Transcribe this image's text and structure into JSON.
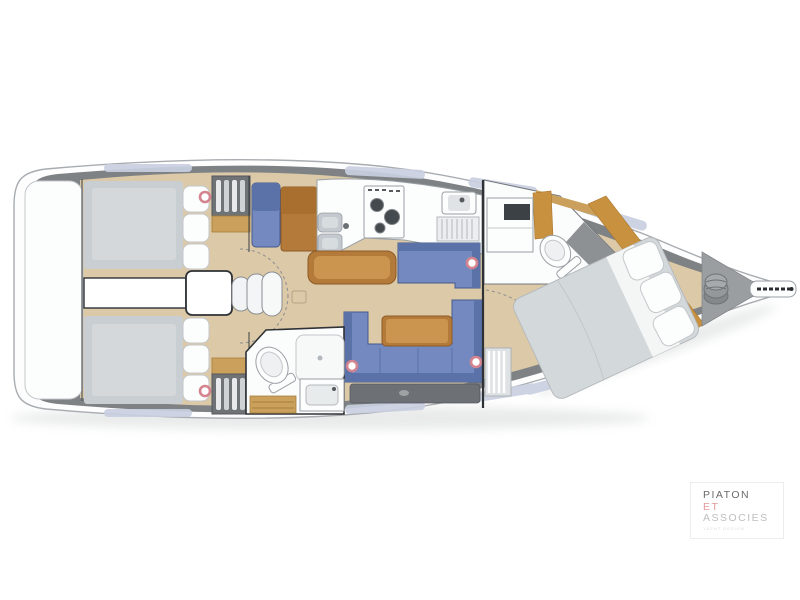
{
  "page": {
    "background": "#ffffff"
  },
  "theme": {
    "page-bg": "#ffffff",
    "hull-fill": "#fdfdfe",
    "hull-stroke": "#a8acb0",
    "deck-gray": "#7e8285",
    "deck-window": "#c9cfe0",
    "floor-wood": "#dcc9a8",
    "floor-plank": "#cdb astro",
    "furniture-wood": "#b37a3a",
    "furniture-wood-dark": "#8c5a26",
    "furniture-wood-light": "#cb9550",
    "furniture-tan": "#caa05c",
    "upholstery-blue": "#7389bf",
    "upholstery-blue-dark": "#5a72a8",
    "upholstery-outline": "#46598b",
    "mattress-gray": "#c9ced2",
    "mattress-gray-light": "#d4d8db",
    "bed-duvet": "#d3d8db",
    "fixture-white": "#fcfdfd",
    "fixture-stroke": "#9aa0a5",
    "soft-stroke": "#c3c7ca",
    "steel-gray": "#c3c9ce",
    "storage-gray": "#6d7175",
    "locker-gray": "#9b9ea1",
    "dark-outline": "#2e3236",
    "hatch-pink": "#d4848e",
    "shadow": "#cfd1d2"
  },
  "floorplan": {
    "type": "sailboat-interior-layout-top-view",
    "orientation": "bow-right-stern-left",
    "areas": [
      "swim-platform",
      "aft-cabin-port",
      "aft-cabin-starboard",
      "engine-compartment",
      "companionway-steps",
      "hanging-lockers",
      "nav-station",
      "galley",
      "salon-settees",
      "salon-table",
      "aft-head",
      "forward-head",
      "forward-cabin-berth",
      "anchor-locker",
      "bowsprit"
    ],
    "deck_hatches": 5
  },
  "logo": {
    "line1": "PIATON",
    "line2": "ET",
    "line3": "ASSOCIES",
    "tagline": "YACHT DESIGN",
    "color1": "#6a6a6a",
    "color2": "#e29a9b",
    "color3": "#bfbebe",
    "color4": "#d9d9d9"
  }
}
